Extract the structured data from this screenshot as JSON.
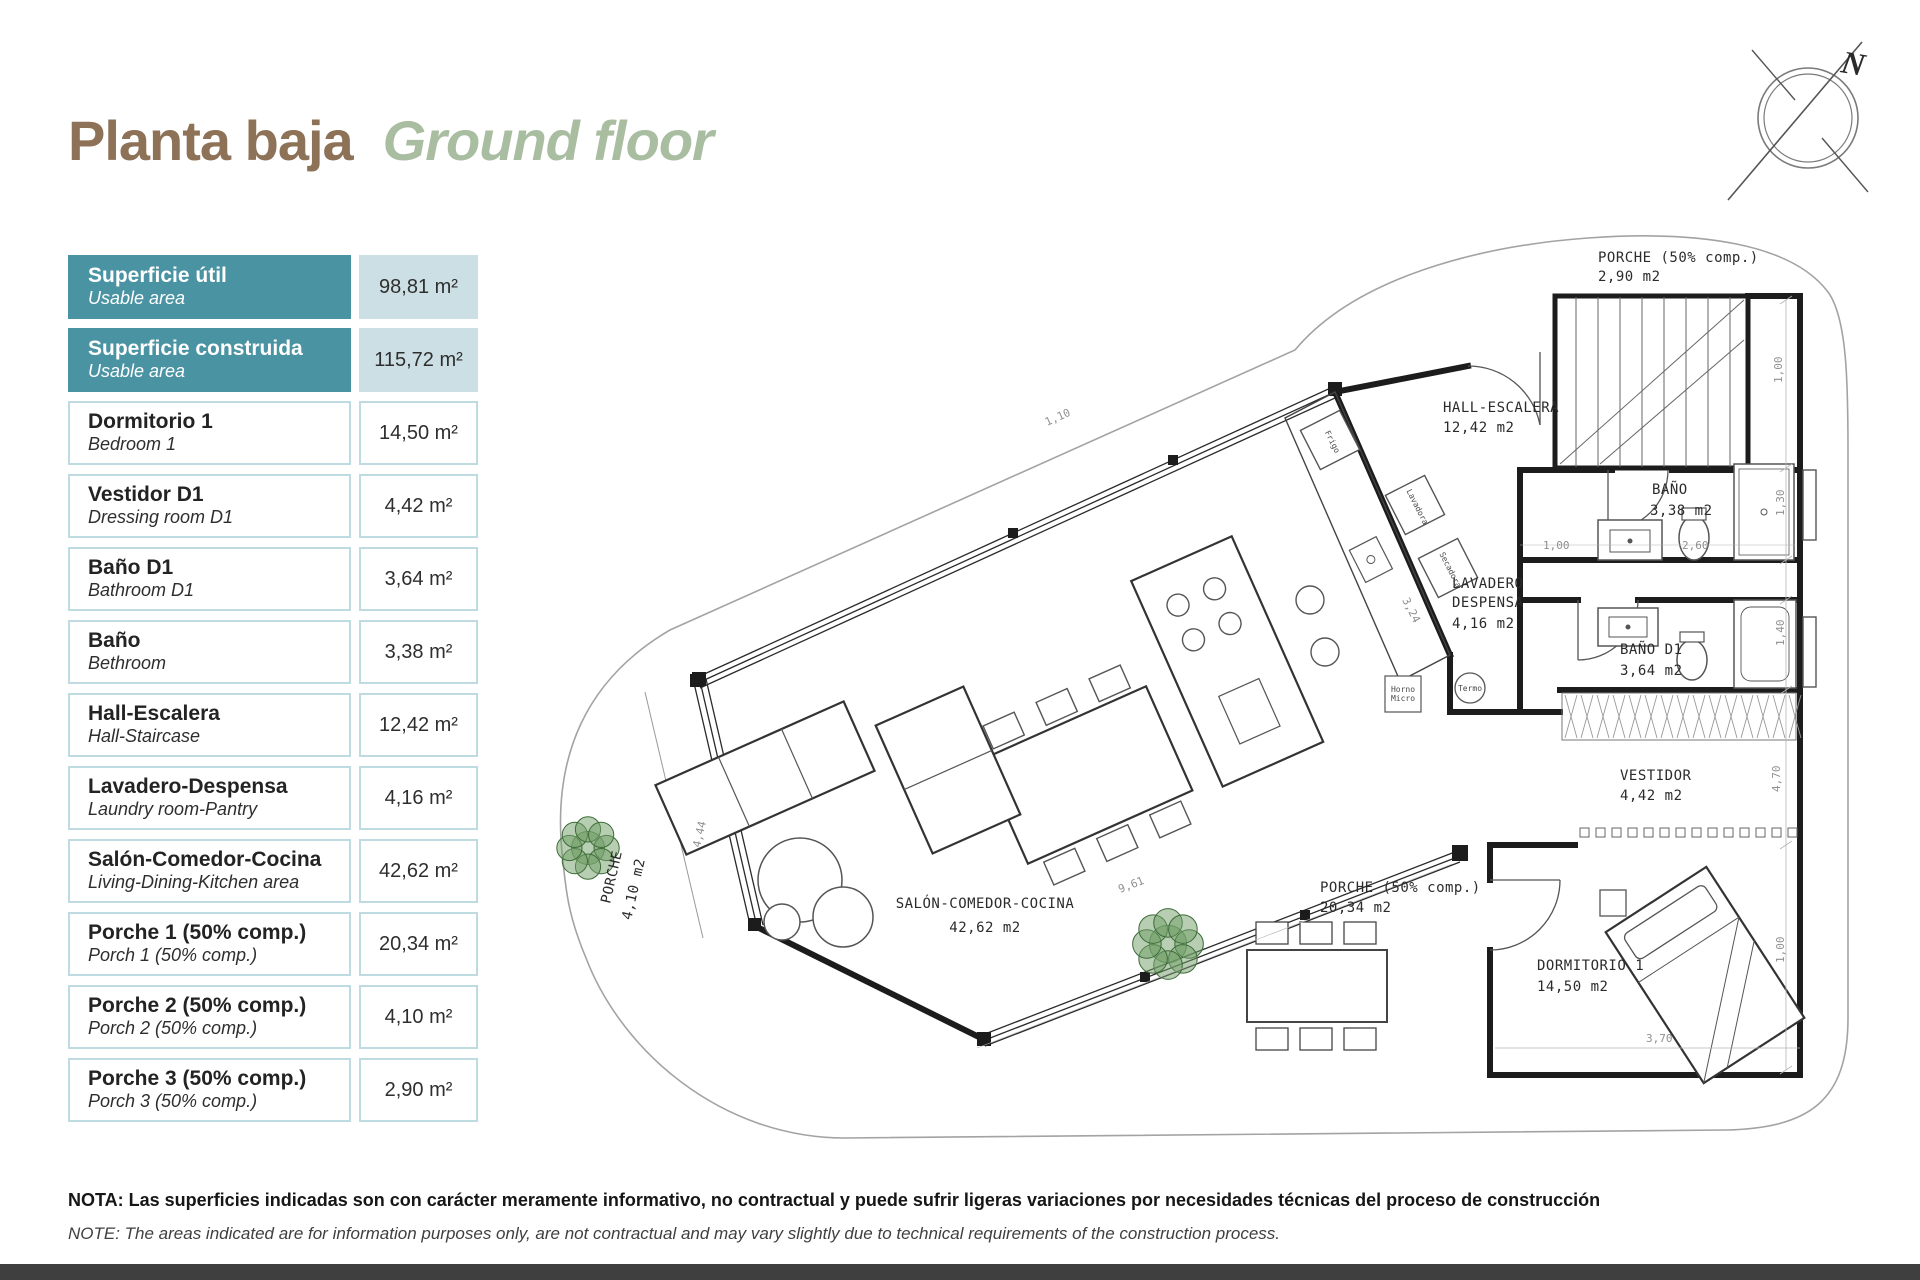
{
  "title": {
    "es": "Planta baja",
    "en": "Ground floor"
  },
  "compass": {
    "north_label": "N"
  },
  "table": {
    "rows": [
      {
        "es": "Superficie útil",
        "en": "Usable area",
        "value": "98,81 m²",
        "highlight": true
      },
      {
        "es": "Superficie construida",
        "en": "Usable area",
        "value": "115,72 m²",
        "highlight": true
      },
      {
        "es": "Dormitorio 1",
        "en": "Bedroom 1",
        "value": "14,50 m²",
        "highlight": false
      },
      {
        "es": "Vestidor D1",
        "en": "Dressing room D1",
        "value": "4,42 m²",
        "highlight": false
      },
      {
        "es": "Baño D1",
        "en": "Bathroom D1",
        "value": "3,64 m²",
        "highlight": false
      },
      {
        "es": "Baño",
        "en": "Bethroom",
        "value": "3,38 m²",
        "highlight": false
      },
      {
        "es": "Hall-Escalera",
        "en": "Hall-Staircase",
        "value": "12,42 m²",
        "highlight": false
      },
      {
        "es": "Lavadero-Despensa",
        "en": "Laundry room-Pantry",
        "value": "4,16 m²",
        "highlight": false
      },
      {
        "es": "Salón-Comedor-Cocina",
        "en": "Living-Dining-Kitchen area",
        "value": "42,62 m²",
        "highlight": false
      },
      {
        "es": "Porche 1 (50% comp.)",
        "en": "Porch 1 (50% comp.)",
        "value": "20,34 m²",
        "highlight": false
      },
      {
        "es": "Porche 2 (50% comp.)",
        "en": "Porch 2 (50% comp.)",
        "value": "4,10 m²",
        "highlight": false
      },
      {
        "es": "Porche 3 (50% comp.)",
        "en": "Porch 3 (50% comp.)",
        "value": "2,90 m²",
        "highlight": false
      }
    ]
  },
  "plan": {
    "labels": [
      {
        "t": "PORCHE (50% comp.)",
        "x": 1598,
        "y": 262
      },
      {
        "t": "2,90 m2",
        "x": 1598,
        "y": 281
      },
      {
        "t": "HALL-ESCALERA",
        "x": 1443,
        "y": 412
      },
      {
        "t": "12,42 m2",
        "x": 1443,
        "y": 432
      },
      {
        "t": "BAÑO",
        "x": 1652,
        "y": 494
      },
      {
        "t": "3,38 m2",
        "x": 1650,
        "y": 515
      },
      {
        "t": "LAVADERO",
        "x": 1452,
        "y": 588
      },
      {
        "t": "DESPENSA",
        "x": 1452,
        "y": 607
      },
      {
        "t": "4,16 m2",
        "x": 1452,
        "y": 628
      },
      {
        "t": "BAÑO D1",
        "x": 1620,
        "y": 654
      },
      {
        "t": "3,64 m2",
        "x": 1620,
        "y": 675
      },
      {
        "t": "VESTIDOR",
        "x": 1620,
        "y": 780
      },
      {
        "t": "4,42 m2",
        "x": 1620,
        "y": 800
      },
      {
        "t": "DORMITORIO 1",
        "x": 1537,
        "y": 970
      },
      {
        "t": "14,50 m2",
        "x": 1537,
        "y": 991
      },
      {
        "t": "PORCHE (50% comp.)",
        "x": 1320,
        "y": 892
      },
      {
        "t": "20,34 m2",
        "x": 1320,
        "y": 912
      },
      {
        "t": "SALÓN-COMEDOR-COCINA",
        "x": 985,
        "y": 908,
        "a": "m"
      },
      {
        "t": "42,62 m2",
        "x": 985,
        "y": 932,
        "a": "m"
      },
      {
        "t": "PORCHE",
        "x": 616,
        "y": 878,
        "r": -77,
        "a": "m"
      },
      {
        "t": "4,10 m2",
        "x": 638,
        "y": 890,
        "r": -77,
        "a": "m"
      },
      {
        "t": "1,10",
        "x": 1047,
        "y": 426,
        "r": -24,
        "c": "dim"
      },
      {
        "t": "1,00",
        "x": 1543,
        "y": 549,
        "c": "dim"
      },
      {
        "t": "2,60",
        "x": 1682,
        "y": 549,
        "c": "dim"
      },
      {
        "t": "1,30",
        "x": 1784,
        "y": 516,
        "r": -90,
        "c": "dim"
      },
      {
        "t": "1,40",
        "x": 1784,
        "y": 646,
        "r": -90,
        "c": "dim"
      },
      {
        "t": "4,70",
        "x": 1780,
        "y": 792,
        "r": -90,
        "c": "dim"
      },
      {
        "t": "1,00",
        "x": 1782,
        "y": 383,
        "r": -90,
        "c": "dim"
      },
      {
        "t": "1,00",
        "x": 1784,
        "y": 963,
        "r": -90,
        "c": "dim"
      },
      {
        "t": "3,24",
        "x": 1402,
        "y": 600,
        "r": 63,
        "c": "dim"
      },
      {
        "t": "9,61",
        "x": 1120,
        "y": 893,
        "r": -21,
        "c": "dim"
      },
      {
        "t": "4,44",
        "x": 700,
        "y": 848,
        "r": -77,
        "c": "dim"
      },
      {
        "t": "3,70",
        "x": 1646,
        "y": 1042,
        "c": "dim"
      },
      {
        "t": "Frigo",
        "x": 1330,
        "y": 443,
        "r": 63,
        "c": "tiny",
        "a": "m"
      },
      {
        "t": "Lavadora",
        "x": 1415,
        "y": 508,
        "r": 63,
        "c": "tiny",
        "a": "m"
      },
      {
        "t": "Secadora",
        "x": 1448,
        "y": 571,
        "r": 63,
        "c": "tiny",
        "a": "m"
      },
      {
        "t": "Termo",
        "x": 1470,
        "y": 691,
        "c": "tiny",
        "a": "m"
      },
      {
        "t": "Horno",
        "x": 1403,
        "y": 692,
        "c": "tiny",
        "a": "m"
      },
      {
        "t": "Micro",
        "x": 1403,
        "y": 701,
        "c": "tiny",
        "a": "m"
      },
      {
        "t": "N",
        "x": 1840,
        "y": 72,
        "r": 10,
        "c": "north"
      }
    ]
  },
  "note": {
    "es": "NOTA: Las superficies indicadas son con carácter meramente informativo, no contractual y puede sufrir ligeras variaciones por necesidades técnicas del proceso de construcción",
    "en": "NOTE: The areas indicated are for information purposes only, are not contractual and may vary slightly due to technical requirements of the construction process."
  },
  "colors": {
    "header_teal": "#4a93a3",
    "header_value_bg": "#ccdfe4",
    "cell_border": "#bddbe1",
    "title_brown": "#8e7257",
    "title_green": "#a9bda1",
    "tree_green": "#6f9e66",
    "bottom_bar": "#3f3f3f"
  }
}
